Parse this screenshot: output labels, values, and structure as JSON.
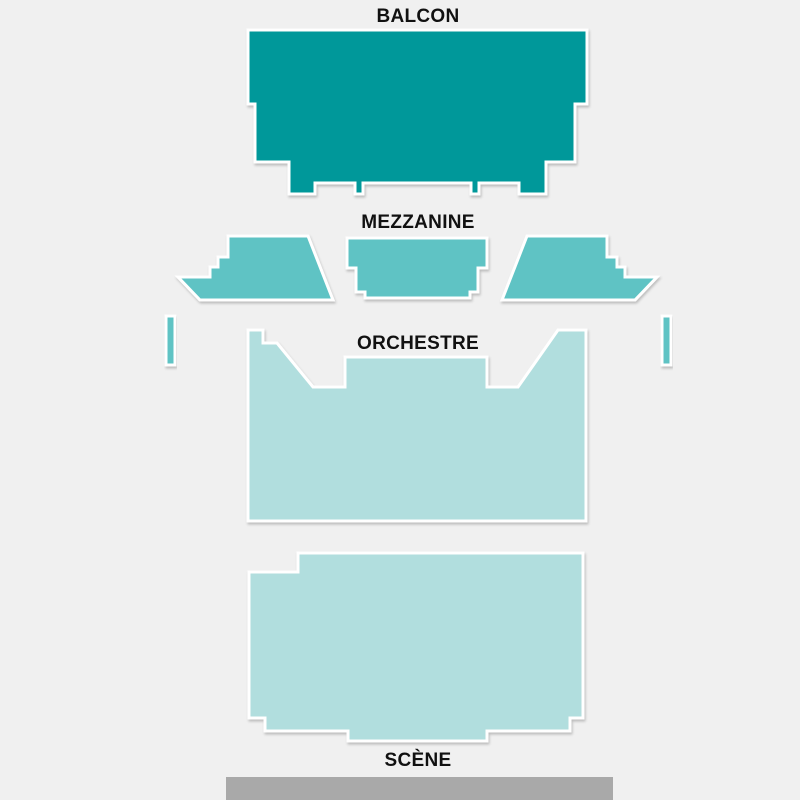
{
  "page": {
    "background": "#f0f0f0"
  },
  "venue_map": {
    "labels": {
      "balcon": "BALCON",
      "mezzanine": "MEZZANINE",
      "orchestre": "ORCHESTRE",
      "scene": "SCÈNE"
    },
    "colors": {
      "balcon": "#00989a",
      "mezzanine": "#5ec3c4",
      "orchestre": "#b1dede",
      "stage": "#a9a9a9",
      "section_stroke": "#ffffff",
      "label_text": "#111111"
    },
    "sections": [
      {
        "id": "balcon",
        "fill_key": "balcon",
        "interactable": true,
        "points": "248,30 587,30 587,104 575,104 575,162 546,162 546,194 519,194 519,183 479,183 479,194 471,194 471,183 363,183 363,194 355,194 355,183 315,183 315,194 289,194 289,162 255,162 255,104 248,104"
      },
      {
        "id": "mezzanine-left",
        "fill_key": "mezzanine",
        "interactable": true,
        "points": "228,236 308,236 333,300 200,300 178,277 210,277 210,267 218,267 218,257 228,257"
      },
      {
        "id": "mezzanine-center",
        "fill_key": "mezzanine",
        "interactable": true,
        "points": "347,238 487,238 487,268 478,268 478,292 470,292 470,298 365,298 365,292 356,292 356,268 347,268"
      },
      {
        "id": "mezzanine-right",
        "fill_key": "mezzanine",
        "interactable": true,
        "points": "527,236 607,236 607,257 617,257 617,267 625,267 625,277 657,277 635,300 502,300"
      },
      {
        "id": "loge-left-strip",
        "fill_key": "mezzanine",
        "interactable": true,
        "points": "166,316 175,316 175,365 166,365"
      },
      {
        "id": "loge-right-strip",
        "fill_key": "mezzanine",
        "interactable": true,
        "points": "662,316 671,316 671,365 662,365"
      },
      {
        "id": "orchestre-rear",
        "fill_key": "orchestre",
        "interactable": true,
        "points": "248,330 263,330 263,343 277,343 313,387 345,387 345,357 487,357 487,387 518,387 558,330 586,330 586,521 248,521"
      },
      {
        "id": "orchestre-front",
        "fill_key": "orchestre",
        "interactable": true,
        "points": "249,572 298,572 298,553 583,553 583,718 570,718 570,731 487,731 487,741 348,741 348,731 265,731 265,718 249,718"
      }
    ],
    "stage": {
      "x": 226,
      "y": 777,
      "width": 387,
      "height": 23
    }
  }
}
